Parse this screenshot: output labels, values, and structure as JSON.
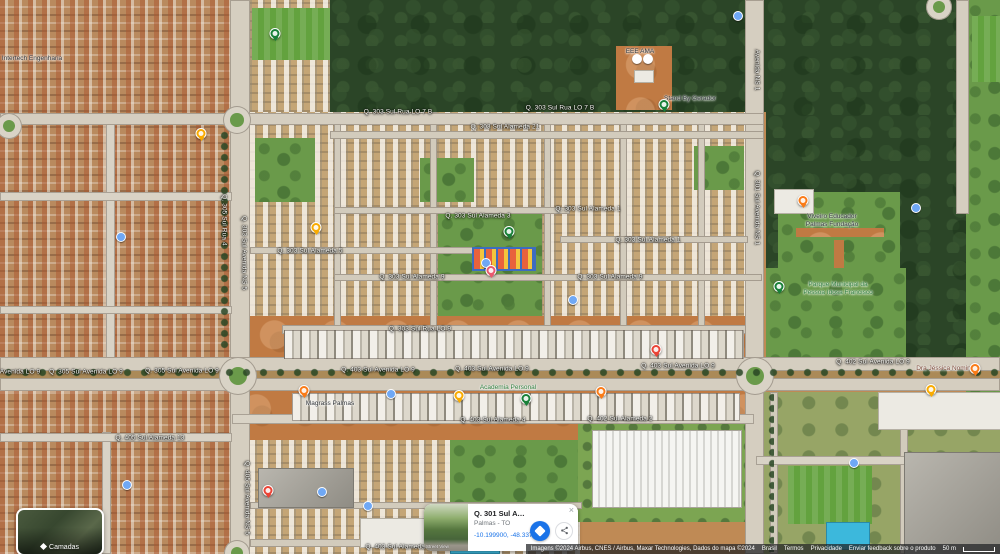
{
  "place_card": {
    "title": "Q. 301 Sul Avenida ...",
    "subtitle": "Palmas - TO",
    "coordinates": "-10.199900, -48.337056",
    "thumbnail_label": "Street View",
    "close_icon": "×"
  },
  "layers_button": {
    "label": "Camadas"
  },
  "attribution": {
    "imagery": "Imagens ©2024 Airbus, CNES / Airbus, Maxar Technologies, Dados do mapa ©2024",
    "links": {
      "country": "Brasil",
      "terms": "Termos",
      "privacy": "Privacidade",
      "feedback": "Enviar feedback sobre o produto"
    },
    "scale": "50 m"
  },
  "roads": [
    {
      "text": "Q. 303 Sul Rua LO 7 B"
    },
    {
      "text": "Q. 303 Sul Rua LO 7 B"
    },
    {
      "text": "Q. 303 Sul Alameda 21"
    },
    {
      "text": "Q. 303 Sul Alameda 1"
    },
    {
      "text": "Q. 303 Sul Alameda 1"
    },
    {
      "text": "Q. 303 Sul Alameda 3"
    },
    {
      "text": "Q. 303 Sul Alameda 5"
    },
    {
      "text": "Q. 303 Sul Alameda 9"
    },
    {
      "text": "Q. 303 Sul Alameda 9"
    },
    {
      "text": "Q. 303 Sul Rua LO 9"
    },
    {
      "text": "Q. 403 Sul Avenida LO 9"
    },
    {
      "text": "Q. 403 Sul Avenida LO 9"
    },
    {
      "text": "Q. 403 Sul Avenida LO 9"
    },
    {
      "text": "Q. 402 Sul Avenida LO 9"
    },
    {
      "text": "Avenida LO 9"
    },
    {
      "text": "Q. 305 Sul Avenida LO 9"
    },
    {
      "text": "Q. 305 Sul Avenida LO 9"
    },
    {
      "text": "Q. 403 Sul Alameda 4"
    },
    {
      "text": "Q. 402 Sul Alameda 2"
    },
    {
      "text": "Q. 405 Sul Alameda 13"
    },
    {
      "text": "Q. 403 Sul Alameda 1"
    },
    {
      "text": "Q. 303 Sul Avenida NS 5"
    },
    {
      "text": "Q. 305 Sul Rua 4"
    },
    {
      "text": "Q. 301 Sul Avenida NS 1"
    },
    {
      "text": "Avenida NS 1"
    },
    {
      "text": "Q. 405 Sul Avenida NS 5"
    }
  ],
  "pois": [
    {
      "label": "EEE AMA"
    },
    {
      "label": "Stand By Gerador"
    },
    {
      "line1": "Viveiro Educador",
      "line2": "Palmas Fundação"
    },
    {
      "line1": "Parque Municipal da",
      "line2": "Pessoa Idosa Francisco"
    },
    {
      "label": "Dra Jéssica Nominato"
    },
    {
      "label": "Academia Personal"
    },
    {
      "label": "Magrass Palmas"
    },
    {
      "label": "Intertech Engenharia"
    }
  ],
  "colors": {
    "accent_blue": "#1a73e8",
    "pin_orange": "#fa7b17",
    "pin_yellow": "#f9ab00",
    "pin_green": "#188038",
    "pin_red": "#ea4335",
    "pin_pink_red": "#e9596e",
    "poi_dot_blue": "#6fa8f5",
    "park_label_green": "#2e7d3c"
  }
}
